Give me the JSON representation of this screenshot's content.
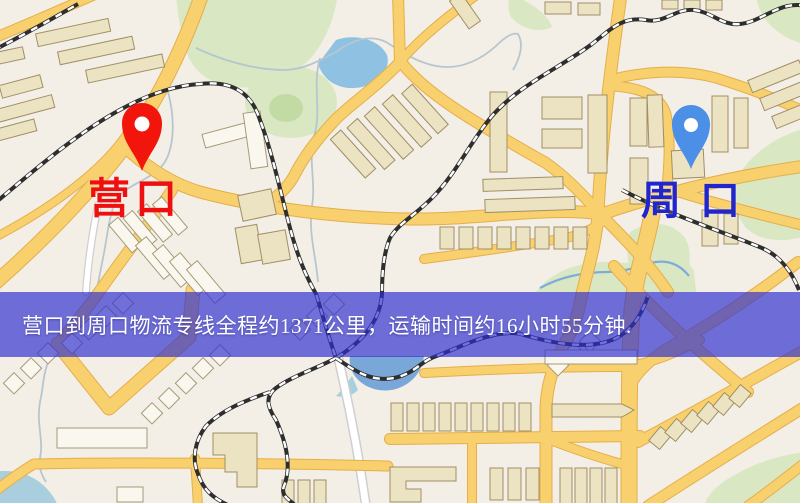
{
  "map": {
    "origin": {
      "label": "营口",
      "label_color": "#ee1010",
      "pin_color": "#f2150c"
    },
    "destination": {
      "label": "周口",
      "label_color": "#2126cc",
      "pin_color": "#4b8fe6"
    },
    "info_banner": {
      "text": "营口到周口物流专线全程约1371公里，运输时间约16小时55分钟.",
      "background": "rgba(47,47,208,0.68)",
      "text_color": "#ffffff",
      "distance_km": "1371",
      "duration": "16小时55分钟"
    },
    "palette": {
      "background": "#f3efe6",
      "road": "#f8d06e",
      "road_edge": "#e5ae49",
      "road_white": "#ffffff",
      "building": "#ece3c3",
      "building_outline": "#a08f66",
      "green": "#d9e8c3",
      "green_dark": "#c2dba4",
      "water": "#8fc2e2",
      "water_deep": "#79a8d8",
      "railway": "#2e2e2e",
      "stream": "#b6c6d0"
    }
  }
}
